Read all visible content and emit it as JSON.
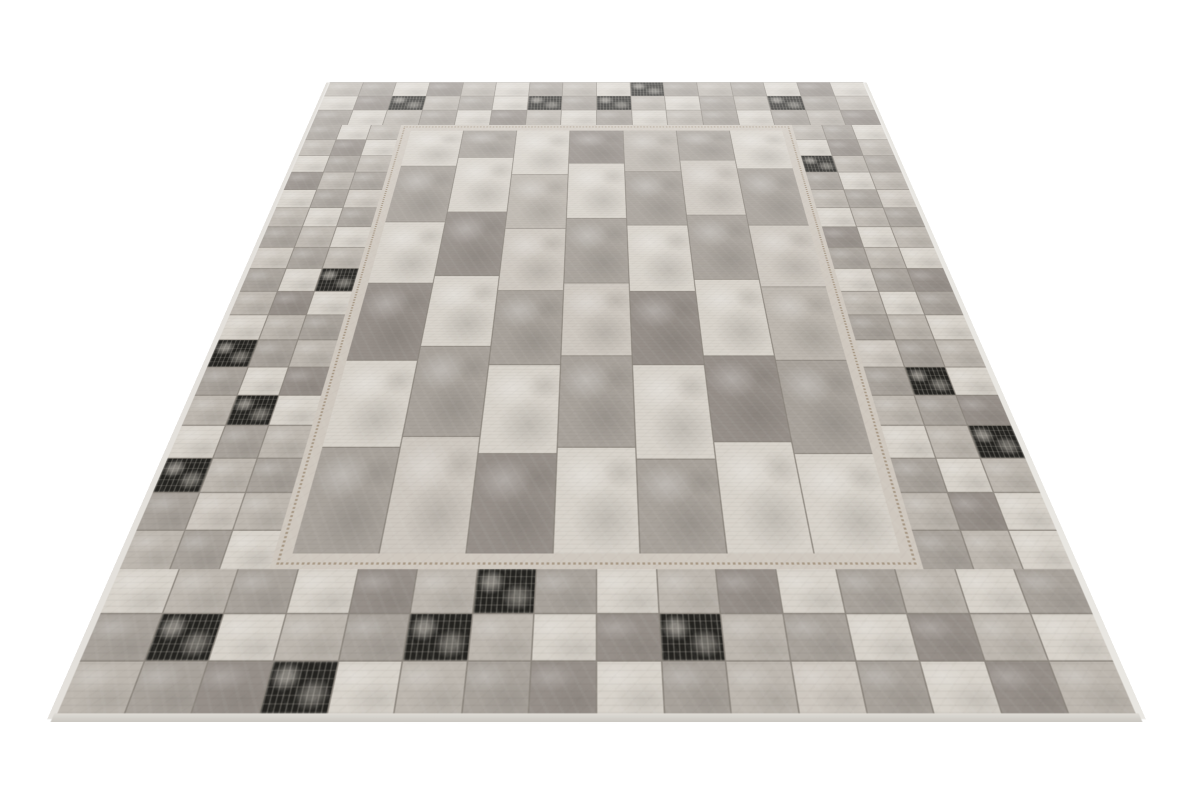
{
  "scene": {
    "background_color": "#ffffff",
    "subject": "patchwork-rug-product-photo",
    "shadow_color": "#46433f"
  },
  "rug": {
    "palette": {
      "L": "#d8d3cb",
      "L2": "#cec8c0",
      "M": "#bdb7af",
      "G": "#a8a29b",
      "G2": "#968f89",
      "D": "#7c766f",
      "K": "#23221f",
      "seam": "#8a847c",
      "stitch": "#a3937f",
      "stitch_band": "#cfc8bf",
      "edge": "#e4e1dc"
    },
    "border": {
      "top": [
        [
          "M",
          "G",
          "L",
          "G2",
          "M",
          "L",
          "G",
          "M",
          "L",
          "K",
          "G",
          "M",
          "G",
          "L",
          "G2",
          "L"
        ],
        [
          "L",
          "G2",
          "K",
          "M",
          "G",
          "L",
          "K",
          "G",
          "K",
          "M",
          "L",
          "G",
          "M",
          "K",
          "G",
          "M"
        ],
        [
          "G",
          "L",
          "M",
          "G",
          "L",
          "G2",
          "M",
          "L",
          "G",
          "L",
          "M",
          "G",
          "L",
          "G",
          "M",
          "G2"
        ]
      ],
      "bottom": [
        [
          "L",
          "M",
          "G",
          "L",
          "G2",
          "M",
          "K",
          "G",
          "L",
          "M",
          "G2",
          "L",
          "G",
          "M",
          "L",
          "G"
        ],
        [
          "G",
          "K",
          "L",
          "M",
          "G",
          "K",
          "M",
          "L",
          "G2",
          "K",
          "M",
          "G",
          "L",
          "G2",
          "M",
          "L"
        ],
        [
          "M",
          "G",
          "G2",
          "K",
          "L",
          "M",
          "G",
          "G2",
          "L",
          "G",
          "M",
          "L2",
          "G",
          "L",
          "G2",
          "M"
        ]
      ],
      "left": [
        [
          "G",
          "L",
          "M"
        ],
        [
          "M",
          "G2",
          "L"
        ],
        [
          "L",
          "G",
          "M"
        ],
        [
          "G2",
          "M",
          "G"
        ],
        [
          "L",
          "G",
          "L2"
        ],
        [
          "M",
          "L",
          "G"
        ],
        [
          "G",
          "M",
          "L"
        ],
        [
          "L2",
          "G",
          "M"
        ],
        [
          "G",
          "L",
          "K"
        ],
        [
          "M",
          "G2",
          "L"
        ],
        [
          "L",
          "M",
          "G"
        ],
        [
          "K",
          "G",
          "M"
        ],
        [
          "G",
          "L",
          "G2"
        ],
        [
          "M",
          "K",
          "L"
        ],
        [
          "L",
          "G",
          "M"
        ],
        [
          "K",
          "M",
          "G"
        ],
        [
          "G",
          "L2",
          "M"
        ],
        [
          "M",
          "G",
          "L"
        ]
      ],
      "right": [
        [
          "M",
          "G",
          "L"
        ],
        [
          "L",
          "G2",
          "M"
        ],
        [
          "K",
          "M",
          "G"
        ],
        [
          "G",
          "L",
          "M"
        ],
        [
          "M",
          "G",
          "L2"
        ],
        [
          "L",
          "M",
          "G"
        ],
        [
          "G2",
          "L",
          "M"
        ],
        [
          "G",
          "M",
          "L"
        ],
        [
          "L",
          "G",
          "G2"
        ],
        [
          "M",
          "L",
          "G"
        ],
        [
          "G",
          "M",
          "L"
        ],
        [
          "L2",
          "G",
          "M"
        ],
        [
          "G",
          "K",
          "L"
        ],
        [
          "M",
          "G",
          "G2"
        ],
        [
          "L",
          "M",
          "K"
        ],
        [
          "G",
          "L",
          "M"
        ],
        [
          "M",
          "G2",
          "L"
        ],
        [
          "G",
          "M",
          "L"
        ]
      ]
    },
    "field": {
      "columns": [
        {
          "tiles": [
            {
              "h": 0.13,
              "c": "L"
            },
            {
              "h": 0.18,
              "c": "G"
            },
            {
              "h": 0.17,
              "c": "L"
            },
            {
              "h": 0.18,
              "c": "G2"
            },
            {
              "h": 0.17,
              "c": "L"
            },
            {
              "h": 0.17,
              "c": "G"
            }
          ]
        },
        {
          "tiles": [
            {
              "h": 0.1,
              "c": "G"
            },
            {
              "h": 0.18,
              "c": "L"
            },
            {
              "h": 0.18,
              "c": "G2"
            },
            {
              "h": 0.17,
              "c": "L"
            },
            {
              "h": 0.18,
              "c": "G"
            },
            {
              "h": 0.19,
              "c": "L2"
            }
          ]
        },
        {
          "tiles": [
            {
              "h": 0.16,
              "c": "L"
            },
            {
              "h": 0.17,
              "c": "M"
            },
            {
              "h": 0.17,
              "c": "L2"
            },
            {
              "h": 0.17,
              "c": "G"
            },
            {
              "h": 0.17,
              "c": "L"
            },
            {
              "h": 0.16,
              "c": "G2"
            }
          ]
        },
        {
          "tiles": [
            {
              "h": 0.12,
              "c": "G2"
            },
            {
              "h": 0.18,
              "c": "L"
            },
            {
              "h": 0.18,
              "c": "G"
            },
            {
              "h": 0.17,
              "c": "L2"
            },
            {
              "h": 0.18,
              "c": "G"
            },
            {
              "h": 0.17,
              "c": "L"
            }
          ]
        },
        {
          "tiles": [
            {
              "h": 0.15,
              "c": "M"
            },
            {
              "h": 0.17,
              "c": "G"
            },
            {
              "h": 0.18,
              "c": "L"
            },
            {
              "h": 0.17,
              "c": "G2"
            },
            {
              "h": 0.18,
              "c": "L"
            },
            {
              "h": 0.15,
              "c": "G"
            }
          ]
        },
        {
          "tiles": [
            {
              "h": 0.11,
              "c": "G"
            },
            {
              "h": 0.18,
              "c": "L2"
            },
            {
              "h": 0.18,
              "c": "G"
            },
            {
              "h": 0.18,
              "c": "L"
            },
            {
              "h": 0.17,
              "c": "G2"
            },
            {
              "h": 0.18,
              "c": "L"
            }
          ]
        },
        {
          "tiles": [
            {
              "h": 0.14,
              "c": "L"
            },
            {
              "h": 0.18,
              "c": "G"
            },
            {
              "h": 0.17,
              "c": "L2"
            },
            {
              "h": 0.17,
              "c": "M"
            },
            {
              "h": 0.18,
              "c": "G"
            },
            {
              "h": 0.16,
              "c": "L"
            }
          ]
        }
      ]
    }
  }
}
